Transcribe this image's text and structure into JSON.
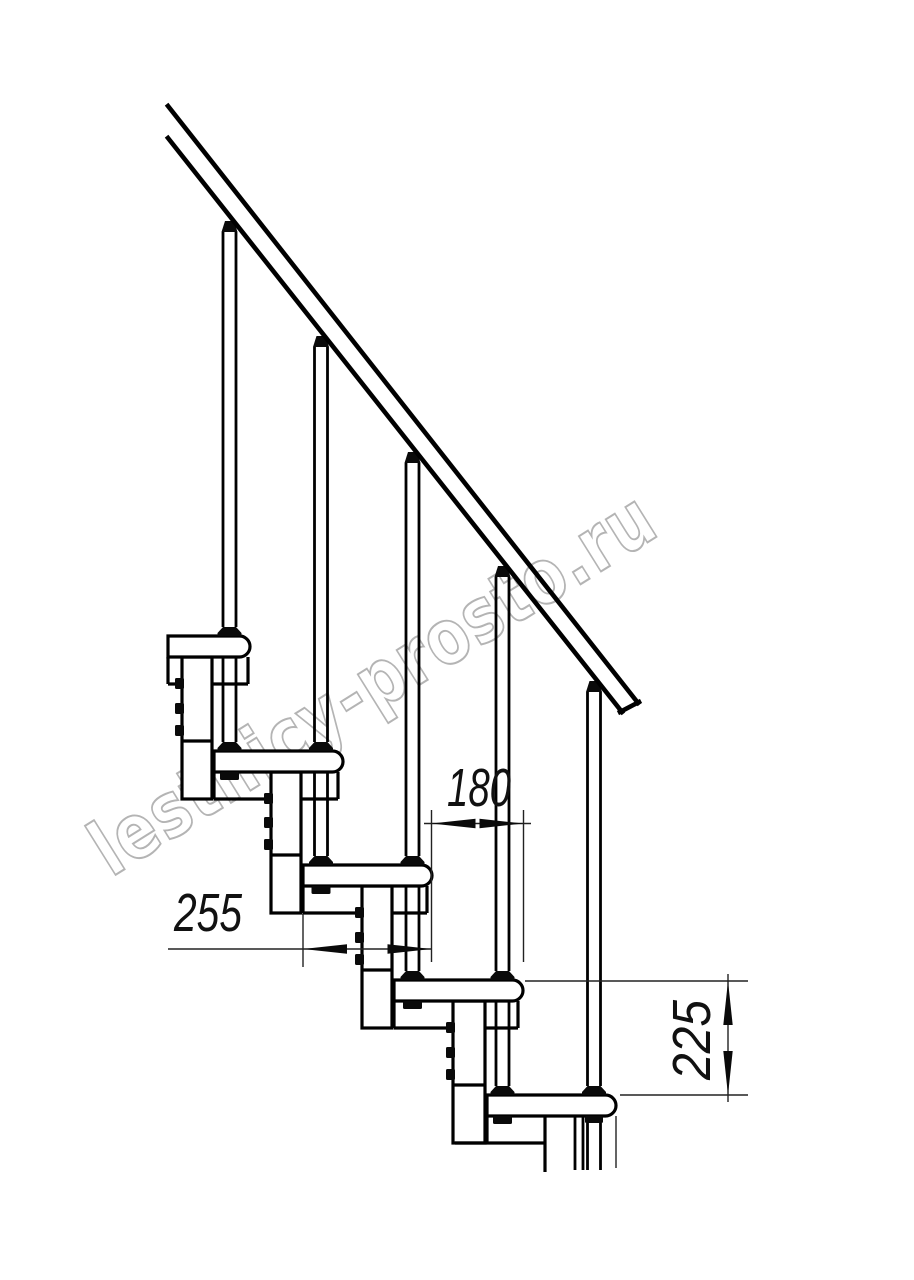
{
  "drawing": {
    "kind": "staircase side-view technical drawing",
    "line_color": "#000000",
    "dim_color": "#222222"
  },
  "dimensions": {
    "step_run": {
      "value": "180"
    },
    "tread_depth": {
      "value": "255"
    },
    "step_rise": {
      "value": "225"
    }
  },
  "watermark": {
    "text": "lestnicy-prosto.ru",
    "color": "#b4b4b4"
  }
}
